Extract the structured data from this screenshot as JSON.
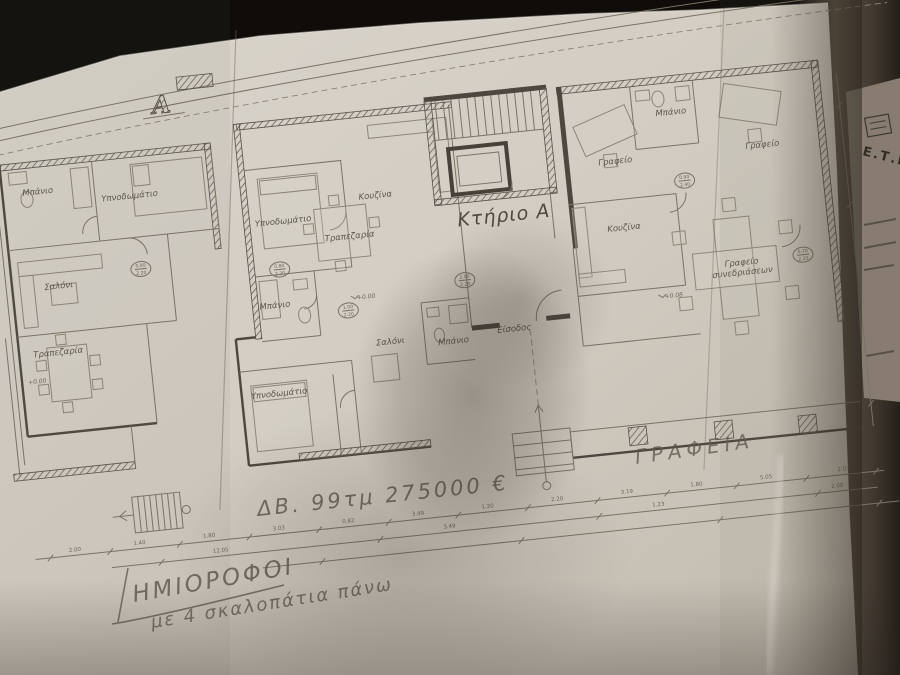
{
  "photo": {
    "paper_color": "#d5cfc5",
    "background_color": "#0f0c09",
    "side_band_color": "#5e5347",
    "pencil_color": "#605a4f"
  },
  "plan": {
    "building_label": "Κτήριο Α",
    "section_marker": "Α",
    "rooms": {
      "left_bathroom": "Μπάνιο",
      "left_bedroom": "Υπνοδωμάτιο",
      "left_living": "Σαλόνι",
      "left_dining": "Τραπεζαρία",
      "mid_bedroom_top": "Υπνοδωμάτιο",
      "mid_dining": "Τραπεζαρία",
      "mid_kitchen": "Κουζίνα",
      "mid_bathroom_top": "Μπάνιο",
      "mid_living": "Σαλόνι",
      "mid_bathroom_small": "Μπάνιο",
      "mid_bedroom_bottom": "Υπνοδωμάτιο",
      "entrance": "Είσοδος",
      "right_office_left": "Γραφείο",
      "right_bathroom": "Μπάνιο",
      "right_office_right": "Γραφείο",
      "right_kitchen": "Κουζίνα",
      "right_meeting_line1": "Γραφείο",
      "right_meeting_line2": "συνεδριάσεων"
    },
    "levels": {
      "a": "+0.00",
      "b": "+0.08",
      "c": "+0.00"
    },
    "door_stamps": [
      {
        "w": "0.90",
        "h": "2.20"
      },
      {
        "w": "0.80",
        "h": "2.20"
      },
      {
        "w": "1.00",
        "h": "2.20"
      },
      {
        "w": "2.00",
        "h": "2.20"
      },
      {
        "w": "0.90",
        "h": "2.40"
      },
      {
        "w": "0.70",
        "h": "2.20"
      }
    ],
    "dimensions": [
      "2.00",
      "1.40",
      "1.80",
      "3.03",
      "0.82",
      "3.49",
      "1.20",
      "2.20",
      "3.19",
      "1.80",
      "5.05",
      "2.03",
      "12.05",
      "3.49",
      "1.23",
      "2.00"
    ]
  },
  "handwriting": {
    "price_note": "ΔΒ.  99τμ  275000 €",
    "offices_note": "ΓΡΑΦΕΙΑ",
    "mezzanine_line1": "ΗΜΙΟΡΟΦΟΙ",
    "mezzanine_line2": "με 4 σκαλοπάτια πάνω"
  },
  "side_sheet": {
    "logo_text": "Ε.Τ.Ι"
  }
}
